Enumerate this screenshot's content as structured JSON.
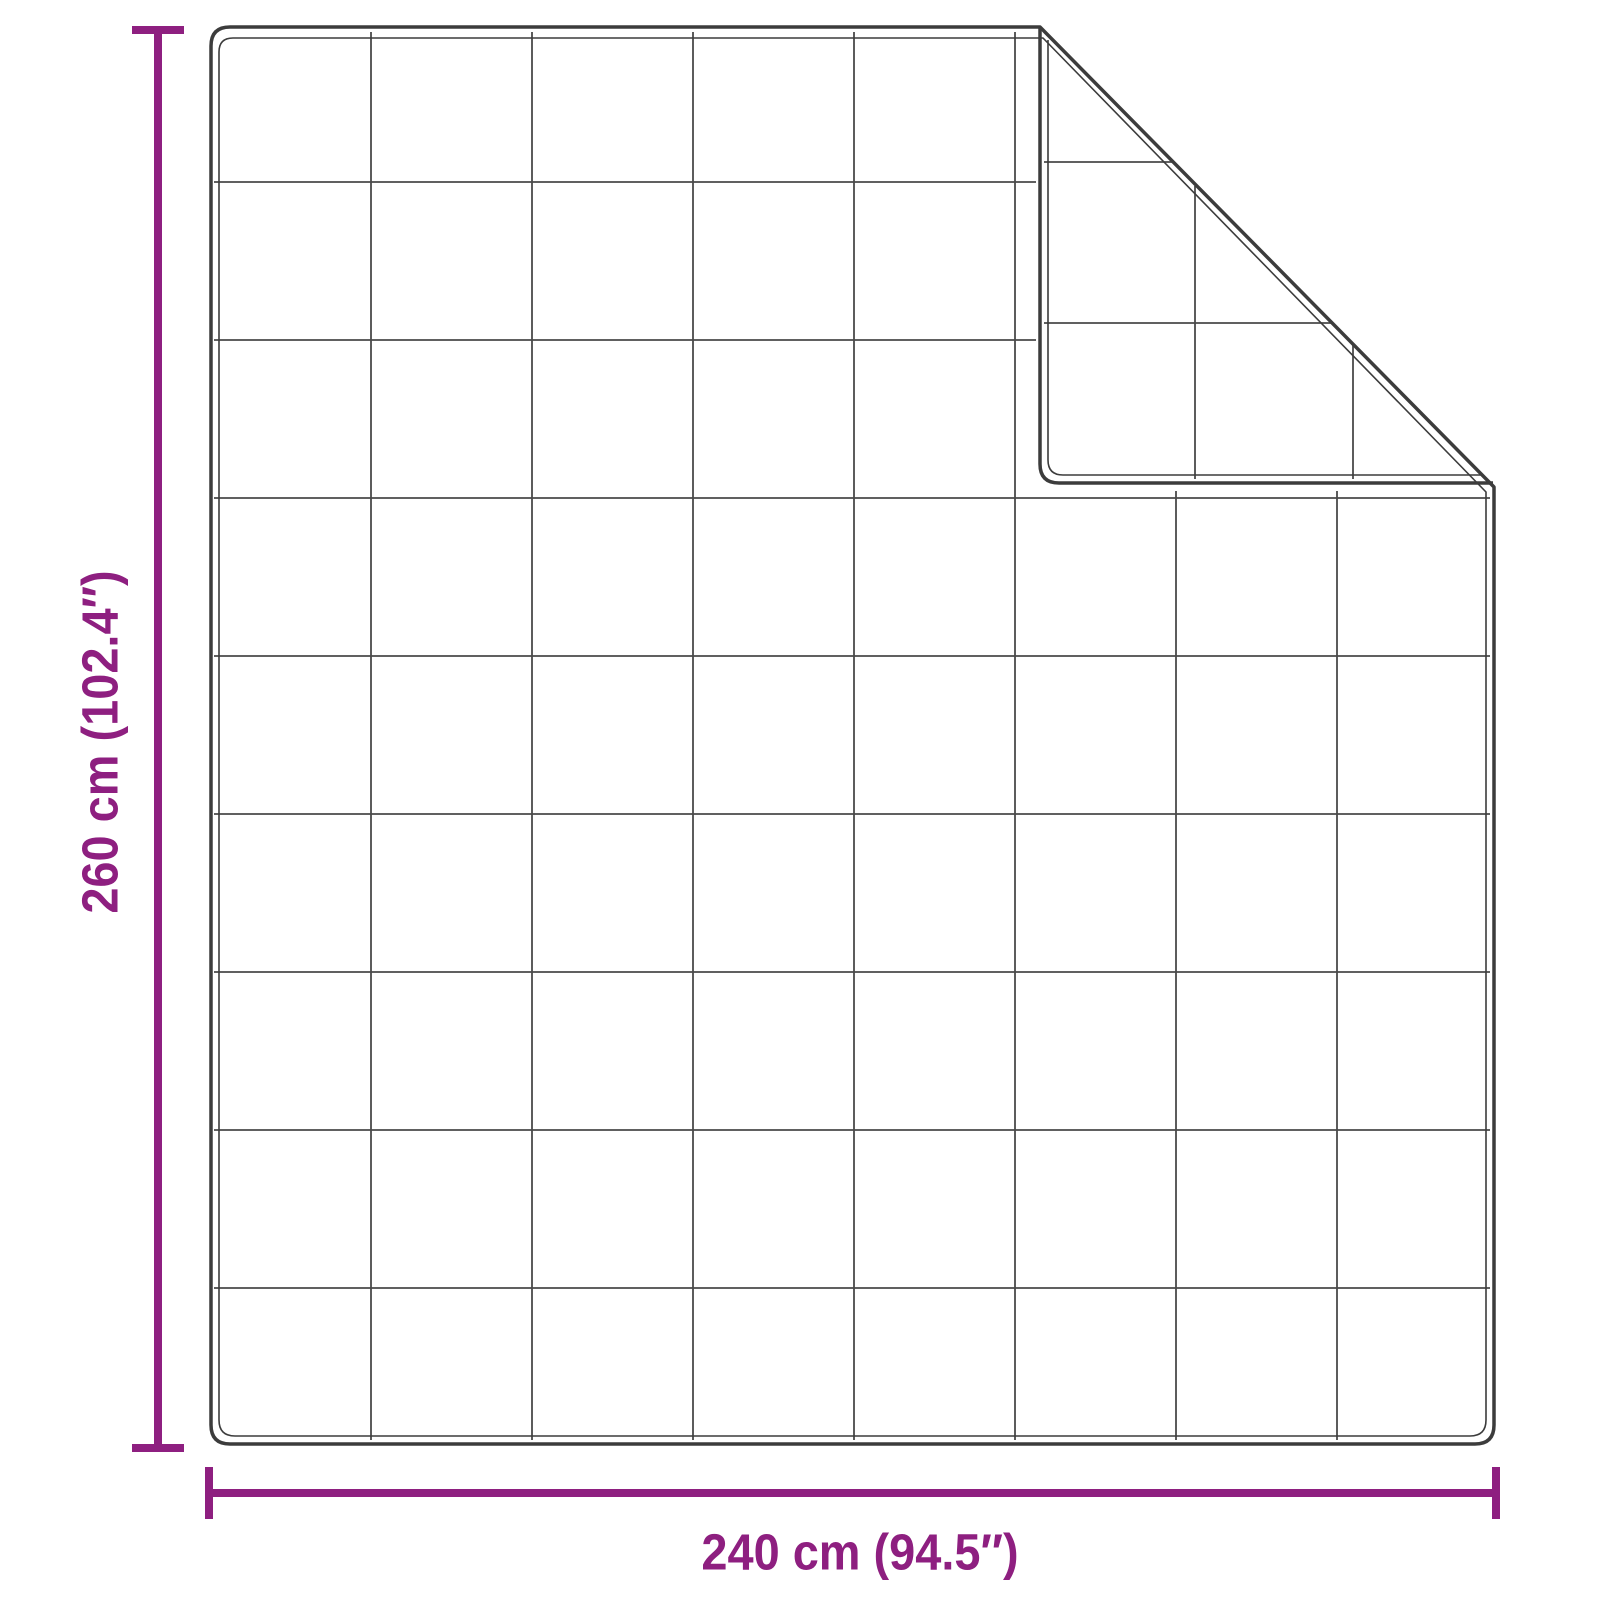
{
  "colors": {
    "accent": "#8E1F80",
    "outline": "#3C3C3C",
    "grid-line": "#4A4A4A",
    "background": "#FFFFFF"
  },
  "dimensions": {
    "height": {
      "label": "260 cm (102.4″)",
      "cm": 260,
      "inches": 102.4
    },
    "width": {
      "label": "240 cm (94.5″)",
      "cm": 240,
      "inches": 94.5
    }
  },
  "blanket": {
    "quilt_grid": {
      "columns": 8,
      "rows": 9
    },
    "folded_corner": "top-right"
  }
}
